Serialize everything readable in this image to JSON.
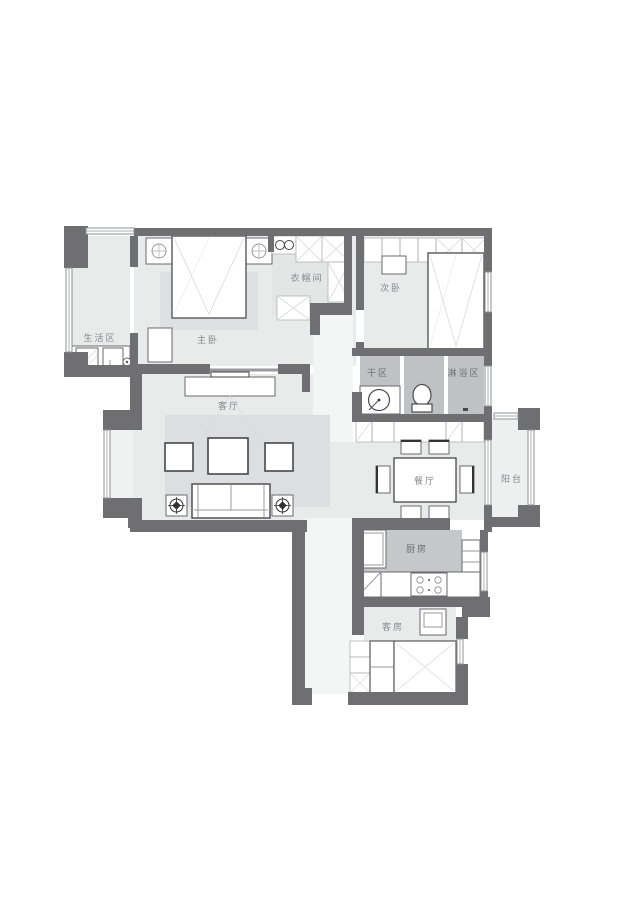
{
  "meta": {
    "type": "apartment-floor-plan",
    "style": "gray-monochrome architectural plan"
  },
  "colors": {
    "wall": "#6f6f71",
    "room_floor": "#e9eaea",
    "closet_floor": "#e4e5e5",
    "wet_floor": "#c0c1c2",
    "kitchen_floor": "#c6c7c8",
    "corridor_floor": "#f4f5f5",
    "rug": "#dddedf",
    "balcony_floor": "#eef0f0",
    "label_text": "#85868a"
  },
  "rooms": {
    "laundry": {
      "label": "生活区"
    },
    "master_bedroom": {
      "label": "主卧"
    },
    "cloakroom": {
      "label": "衣帽间"
    },
    "second_bedroom": {
      "label": "次卧"
    },
    "dry_area": {
      "label": "干区"
    },
    "shower": {
      "label": "淋浴区"
    },
    "living_room": {
      "label": "客厅"
    },
    "dining_room": {
      "label": "餐厅"
    },
    "balcony": {
      "label": "阳台"
    },
    "kitchen": {
      "label": "厨房"
    },
    "guest_room": {
      "label": "客房"
    }
  }
}
